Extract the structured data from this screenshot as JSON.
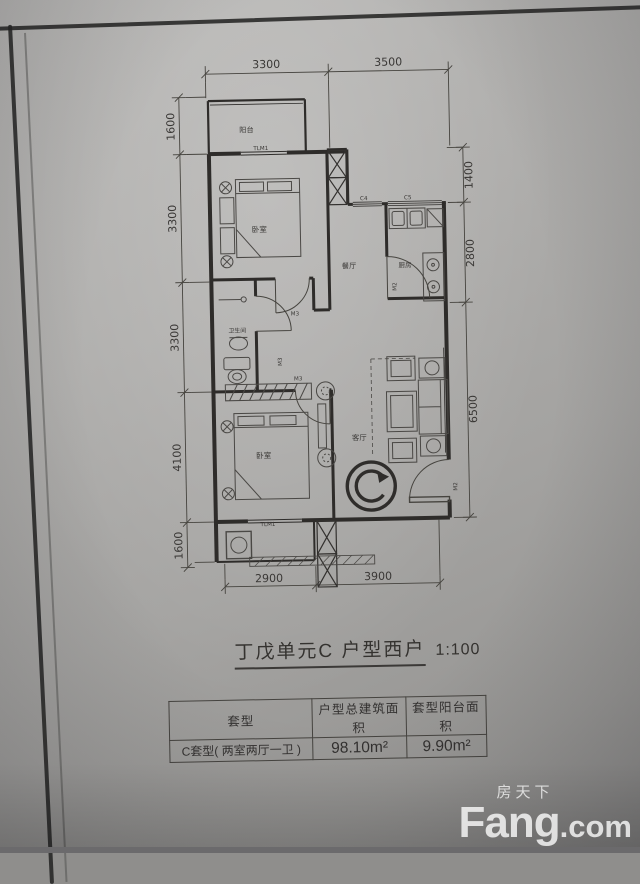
{
  "sheet": {
    "title": "丁戊单元C 户型西户",
    "scale": "1:100",
    "unit_mark": "C"
  },
  "rooms": {
    "balcony_top": "阳台",
    "bedroom_top": "卧室",
    "dining": "餐厅",
    "kitchen": "厨房",
    "bathroom": "卫生间",
    "bedroom_bottom": "卧室",
    "living": "客厅"
  },
  "openings": {
    "tlm_top": "TLM1",
    "c4": "C4",
    "c5": "C5",
    "m2_kitchen": "M2",
    "m3_hall_top": "M3",
    "m3_hall_mid": "M3",
    "m3_bedroom_bottom": "M3",
    "m2_entry": "M2",
    "tlm_bottom": "TLM1"
  },
  "dims": {
    "top": [
      "3300",
      "3500"
    ],
    "left": [
      "1600",
      "3300",
      "3300",
      "4100",
      "1600"
    ],
    "right": [
      "1400",
      "2800",
      "6500"
    ],
    "bottom": [
      "2900",
      "3900"
    ]
  },
  "table": {
    "headers": [
      "套型",
      "户型总建筑面积",
      "套型阳台面积"
    ],
    "row": {
      "type": "C套型( 两室两厅一卫 )",
      "total_area": "98.10m²",
      "balcony_area": "9.90m²"
    }
  },
  "watermark": {
    "cn": "房天下",
    "en_bold": "Fang",
    "en_suffix": ".com"
  }
}
